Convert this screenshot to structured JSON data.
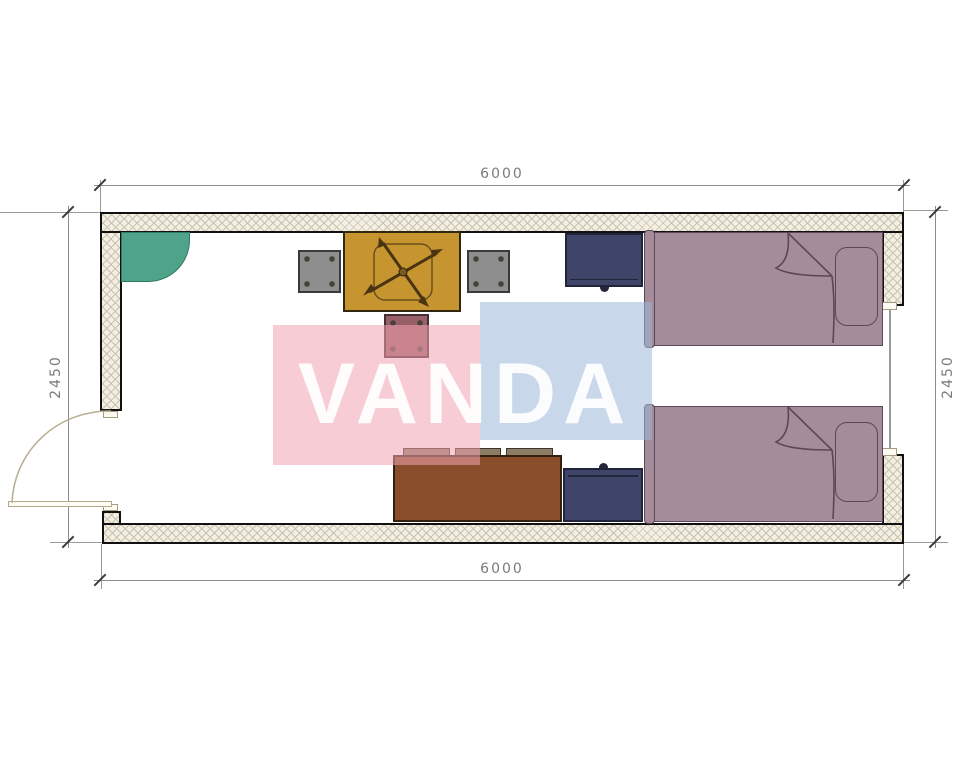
{
  "watermark": {
    "text": "VANDA"
  },
  "dimensions": {
    "top": "6000",
    "bottom": "6000",
    "left": "2450",
    "right": "2450"
  },
  "room": {
    "width_mm": "6000",
    "depth_mm": "2450"
  },
  "colors": {
    "wall_fill": "#f3efe4",
    "wall_hatch": "#c9c2ac",
    "wall_border": "#111111",
    "corner_shelf": "#4fa389",
    "table": "#c7952f",
    "stool_gray": "#8e8e8e",
    "stool_maroon": "#985f68",
    "nightstand": "#3f4469",
    "bed": "#a48c9a",
    "bed_line": "#5a4757",
    "dresser": "#8a4e2c",
    "drawer_tab": "#8d7c66",
    "watermark_pink": "rgba(242,163,176,0.55)",
    "watermark_blue": "rgba(157,182,217,0.55)",
    "dim_line": "#8c8c8c",
    "dim_text": "#7a7a7a",
    "door": "#b7ae92"
  }
}
